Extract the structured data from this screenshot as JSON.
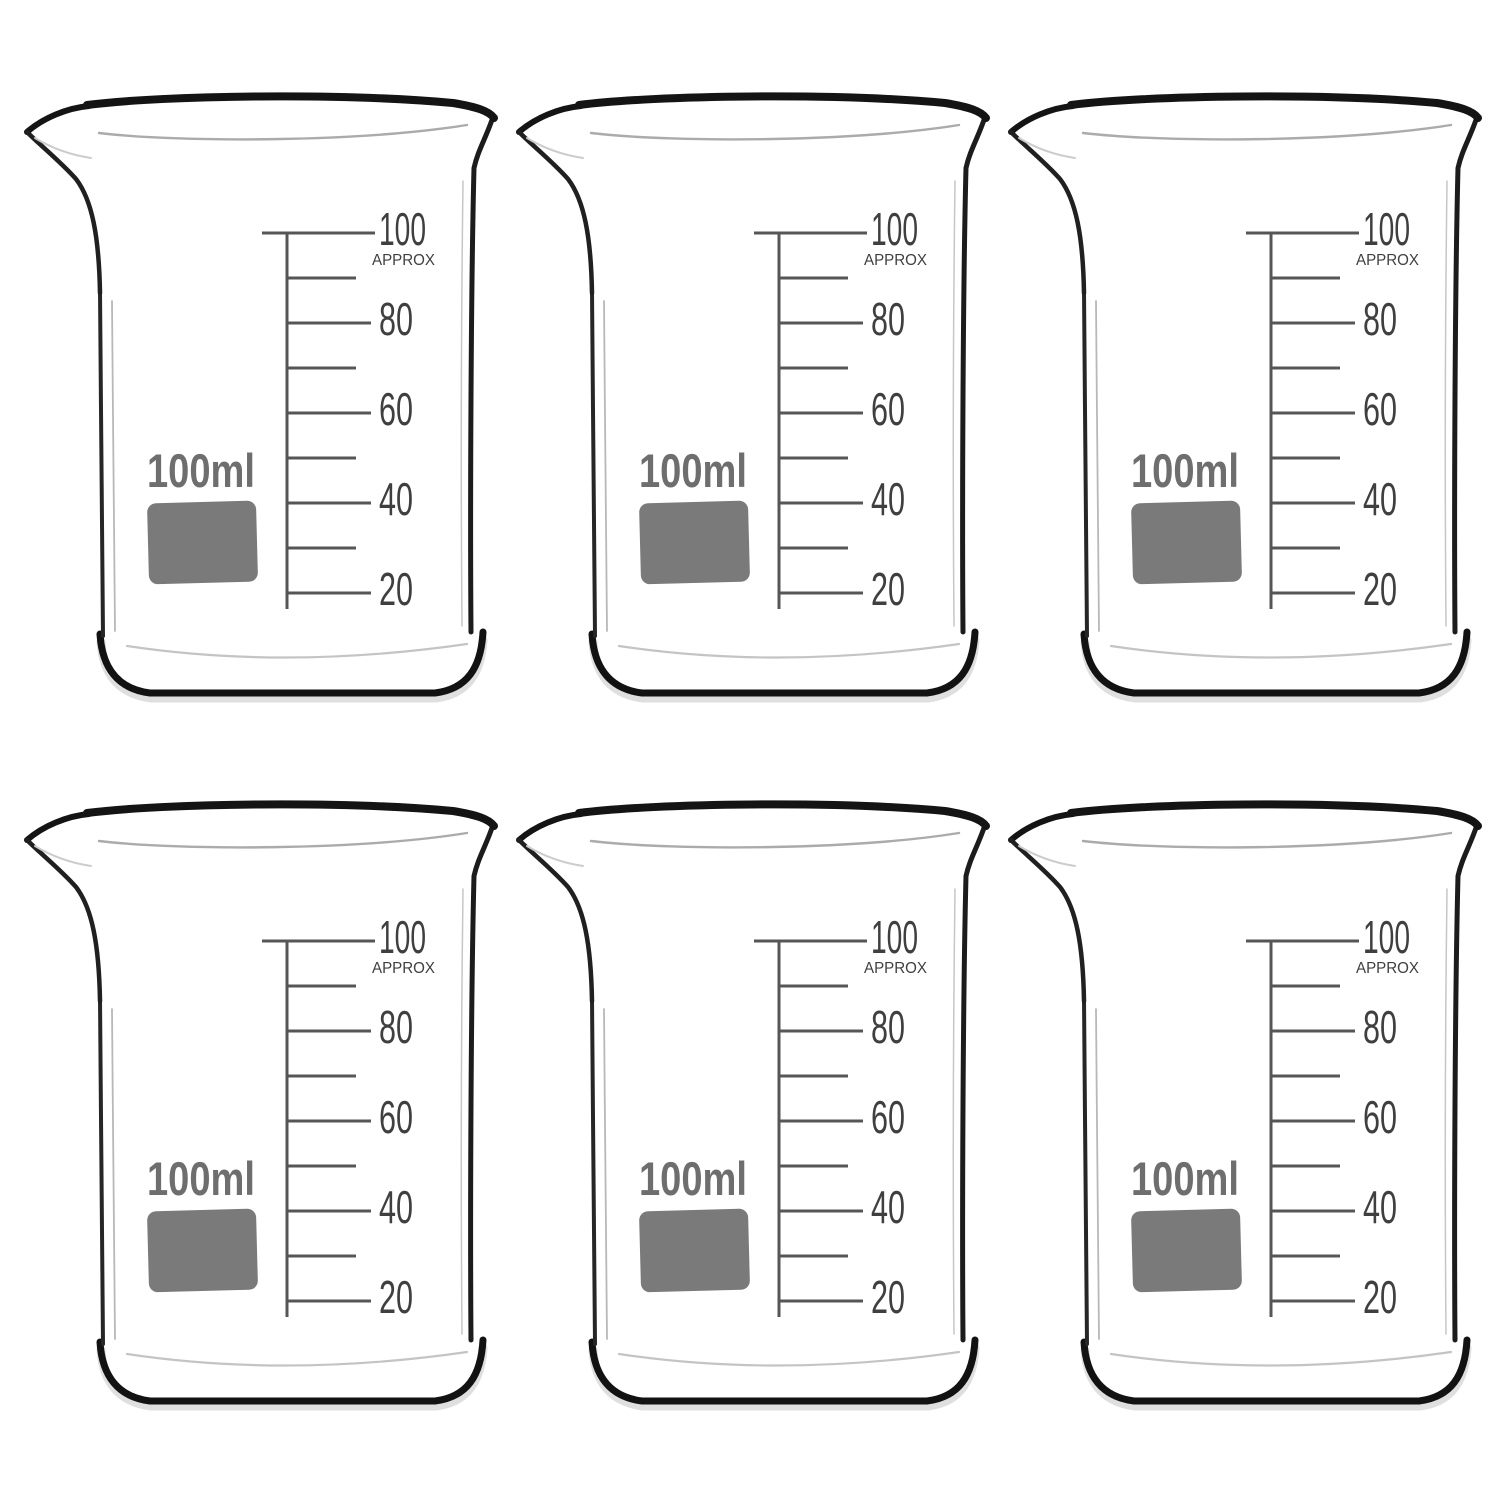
{
  "page": {
    "kind": "product-photo",
    "subject": "glass-beakers",
    "background": "#ffffff"
  },
  "grid": {
    "rows": 2,
    "columns": 3,
    "item_count": 6
  },
  "beaker": {
    "capacity_label": "100ml",
    "approx_label": "APPROX",
    "unit": "ml",
    "scale_labels": [
      "100",
      "80",
      "60",
      "40",
      "20"
    ],
    "scale_values": [
      100,
      80,
      60,
      40,
      20
    ],
    "minor_tick_values": [
      90,
      70,
      50,
      30
    ],
    "swatch": "blank-labeling-square"
  },
  "colors": {
    "page_background": "#ffffff",
    "scale_number_ink": "#3f3f3f",
    "scale_line_ink": "#565656",
    "capacity_ink": "#6e6e6e",
    "swatch_fill": "#7a7a7a",
    "glass_dark": "#141414",
    "glass_mid": "#ababab",
    "glass_shadow": "#dcdcdc"
  }
}
